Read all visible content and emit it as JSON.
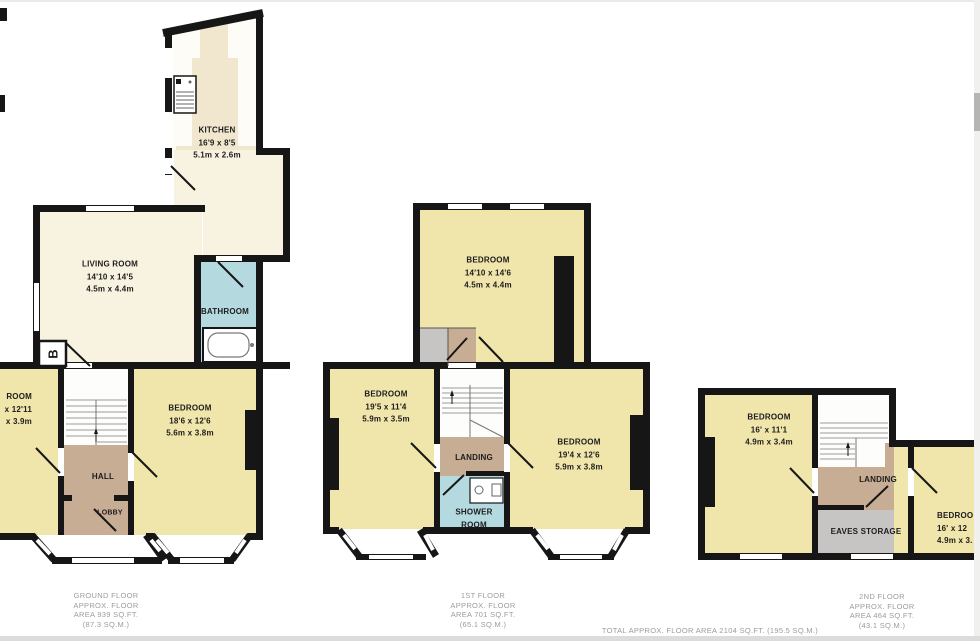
{
  "colors": {
    "room_yellow": "#f0e5ab",
    "room_cream": "#f8f2e1",
    "kitchen_floor": "#f1e7cf",
    "hall_tan": "#c8ad95",
    "bath_blue": "#b4dae0",
    "storage_gray": "#c6c5c3",
    "wall_black": "#161616",
    "caption_gray": "#9c9c9c"
  },
  "plans": {
    "ground": {
      "rooms": {
        "kitchen": {
          "name": "KITCHEN",
          "dim_ft": "16'9 x 8'5",
          "dim_m": "5.1m x 2.6m"
        },
        "living": {
          "name": "LIVING ROOM",
          "dim_ft": "14'10 x 14'5",
          "dim_m": "4.5m x 4.4m"
        },
        "bathroom": {
          "name": "BATHROOM"
        },
        "bedroom_left": {
          "name": "ROOM",
          "dim_ft": "x 12'11",
          "dim_m": "x 3.9m"
        },
        "bedroom_right": {
          "name": "BEDROOM",
          "dim_ft": "18'6 x 12'6",
          "dim_m": "5.6m x 3.8m"
        },
        "hall": {
          "name": "HALL"
        },
        "lobby": {
          "name": "LOBBY"
        },
        "boiler": {
          "label": "B"
        }
      },
      "caption": [
        "GROUND FLOOR",
        "APPROX. FLOOR",
        "AREA 939 SQ.FT.",
        "(87.3 SQ.M.)"
      ]
    },
    "first": {
      "rooms": {
        "bedroom_top": {
          "name": "BEDROOM",
          "dim_ft": "14'10 x 14'6",
          "dim_m": "4.5m x 4.4m"
        },
        "bedroom_left": {
          "name": "BEDROOM",
          "dim_ft": "19'5 x 11'4",
          "dim_m": "5.9m x 3.5m"
        },
        "bedroom_right": {
          "name": "BEDROOM",
          "dim_ft": "19'4 x 12'6",
          "dim_m": "5.9m x 3.8m"
        },
        "landing": {
          "name": "LANDING"
        },
        "shower": {
          "name": "SHOWER",
          "name2": "ROOM"
        }
      },
      "caption": [
        "1ST FLOOR",
        "APPROX. FLOOR",
        "AREA 701 SQ.FT.",
        "(65.1 SQ.M.)"
      ]
    },
    "second": {
      "rooms": {
        "bedroom_left": {
          "name": "BEDROOM",
          "dim_ft": "16' x 11'1",
          "dim_m": "4.9m x 3.4m"
        },
        "landing": {
          "name": "LANDING"
        },
        "eaves": {
          "name": "EAVES STORAGE"
        },
        "bedroom_right": {
          "name": "BEDROO",
          "dim_ft": "16' x 12",
          "dim_m": "4.9m x 3."
        }
      },
      "caption": [
        "2ND FLOOR",
        "APPROX. FLOOR",
        "AREA 464 SQ.FT.",
        "(43.1 SQ.M.)"
      ]
    }
  },
  "total_line": "TOTAL APPROX. FLOOR AREA 2104 SQ.FT. (195.5 SQ.M.)"
}
